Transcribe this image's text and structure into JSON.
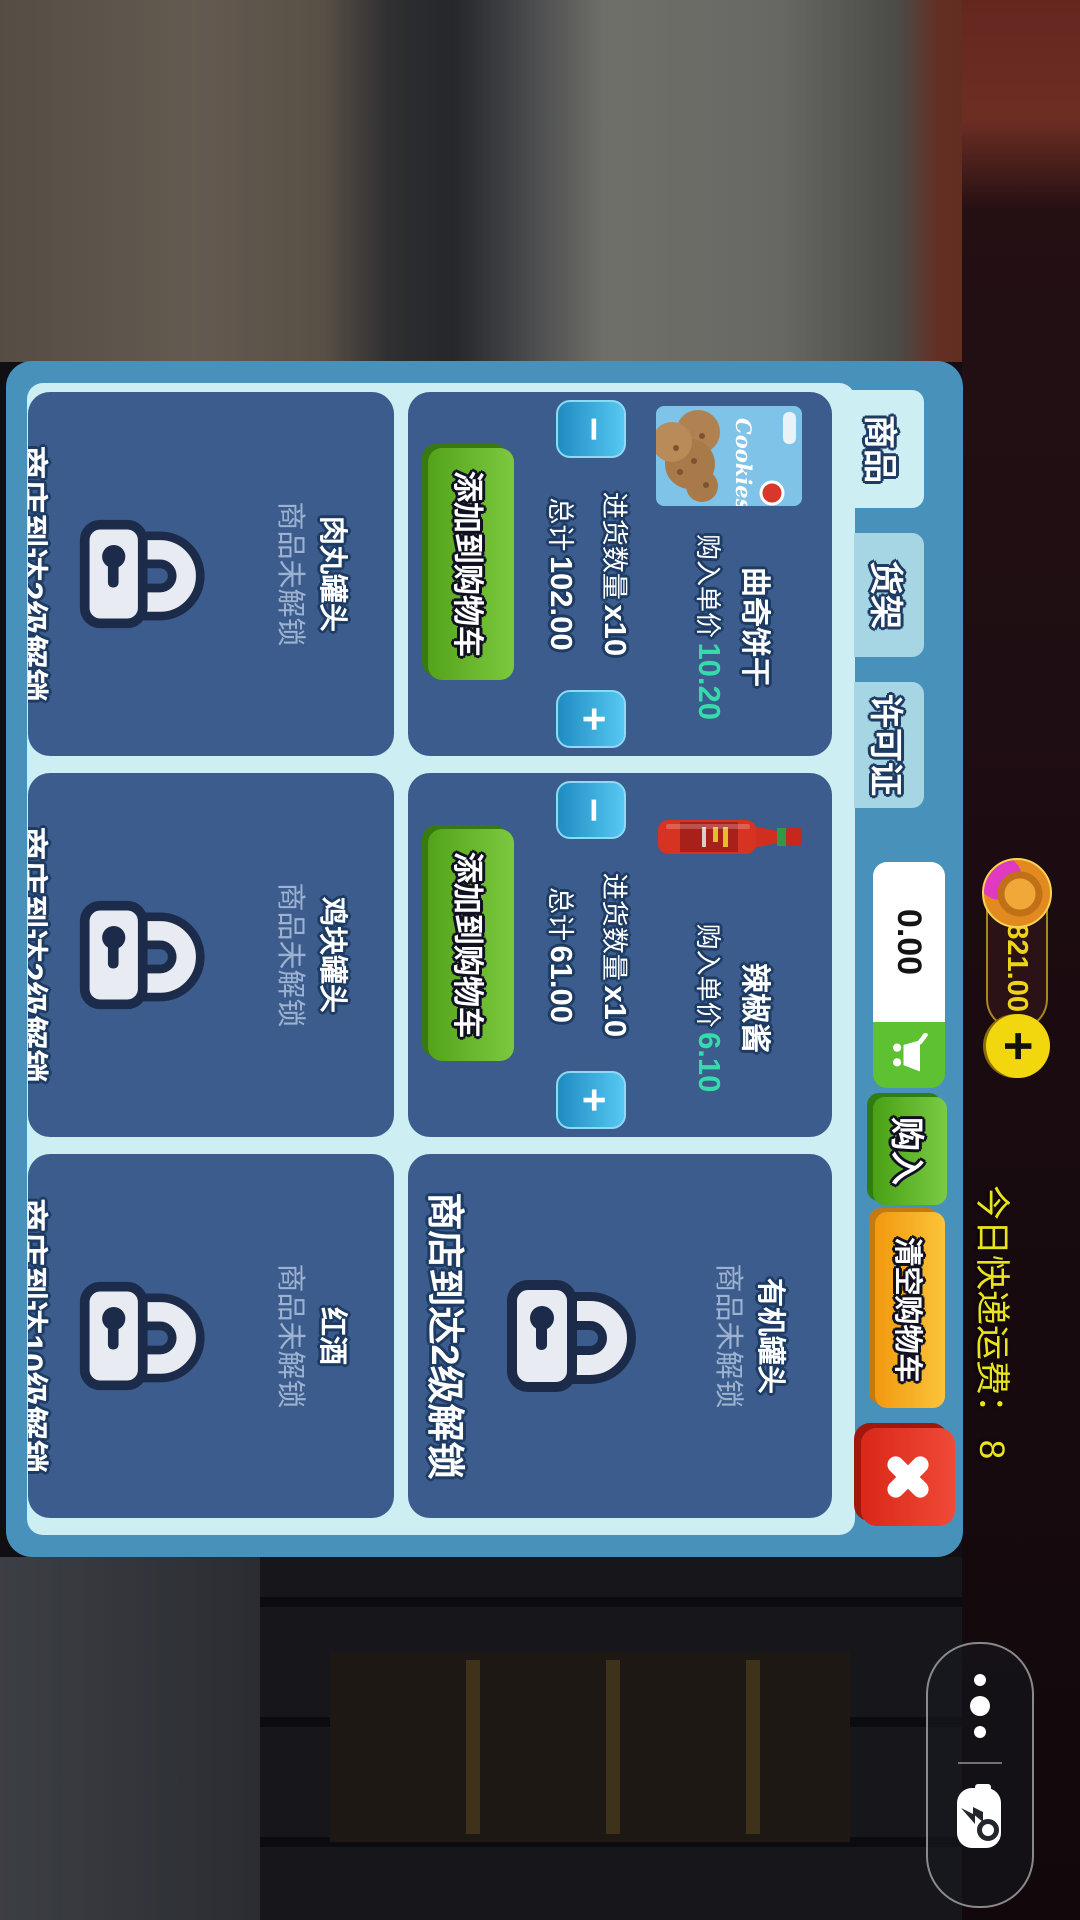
{
  "wallet": {
    "balance": "821.00",
    "add_label": "+"
  },
  "delivery": {
    "note": "今日快递运费： 8"
  },
  "tabs": [
    {
      "label": "商品"
    },
    {
      "label": "货架"
    },
    {
      "label": "许可证"
    }
  ],
  "cart_bar": {
    "total": "0.00",
    "buy_label": "购入",
    "clear_label": "清空购物车"
  },
  "stepper": {
    "minus": "−",
    "plus": "+"
  },
  "labels": {
    "unit_price": "购入单价",
    "order_qty": "进货数量",
    "total": "总计",
    "add_to_cart": "添加到购物车",
    "locked": "商品未解锁"
  },
  "products": [
    {
      "name": "曲奇饼干",
      "unit_price": "10.20",
      "qty": "x10",
      "total": "102.00",
      "image": "cookies-box",
      "image_text": "Cookies"
    },
    {
      "name": "辣椒酱",
      "unit_price": "6.10",
      "qty": "x10",
      "total": "61.00",
      "image": "hot-sauce-bottle"
    },
    {
      "name": "有机罐头",
      "unlock_text": "商店到达2级解锁"
    },
    {
      "name": "肉丸罐头",
      "unlock_text": "商店到达2级解锁"
    },
    {
      "name": "鸡块罐头",
      "unlock_text": "商店到达2级解锁"
    },
    {
      "name": "红酒",
      "unlock_text": "商店到达10级解锁"
    }
  ],
  "icons": {
    "cart": "shopping-cart-icon",
    "close": "close-x-icon",
    "coin": "gold-coin-icon",
    "more": "more-dots-icon",
    "gamepad": "game-controller-icon",
    "lock": "padlock-icon"
  },
  "colors": {
    "panel_frame": "#4791ba",
    "panel_inner": "#cdeef3",
    "card": "#3b5c8c",
    "green": "#5cb82a",
    "orange": "#f5a623",
    "red": "#e3392b",
    "stepper_blue": "#2fa7dd",
    "price_teal": "#35dcab",
    "coin_yellow": "#f2d318",
    "note_yellow": "#e9e41f"
  }
}
